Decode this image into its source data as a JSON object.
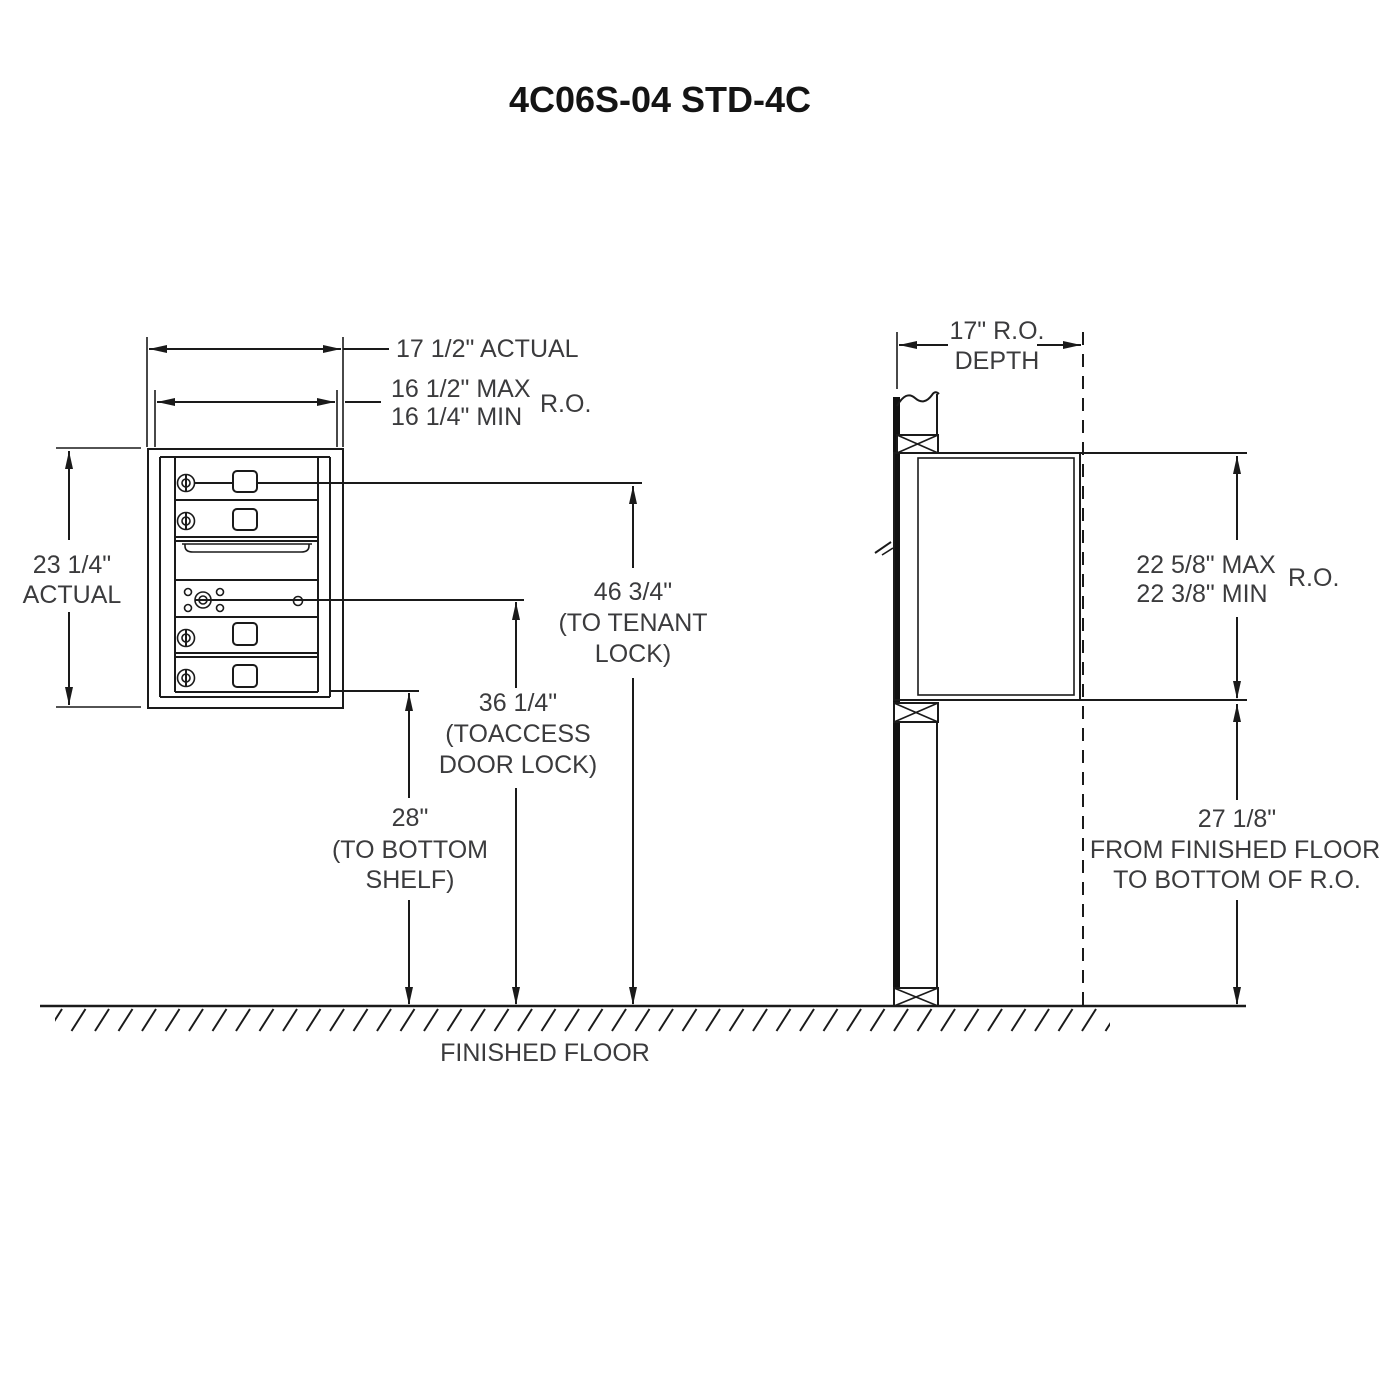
{
  "title": "4C06S-04 STD-4C",
  "front_view": {
    "width_actual_label": "17 1/2\" ACTUAL",
    "width_ro_max": "16 1/2\" MAX",
    "width_ro_min": "16 1/4\" MIN",
    "width_ro_suffix": "R.O.",
    "height_actual_value": "23 1/4\"",
    "height_actual_word": "ACTUAL",
    "tenant_lock_value": "46 3/4\"",
    "tenant_lock_line2": "(TO TENANT",
    "tenant_lock_line3": "LOCK)",
    "access_lock_value": "36 1/4\"",
    "access_lock_line2": "(TOACCESS",
    "access_lock_line3": "DOOR LOCK)",
    "bottom_shelf_value": "28\"",
    "bottom_shelf_line2": "(TO BOTTOM",
    "bottom_shelf_line3": "SHELF)"
  },
  "side_view": {
    "depth_line1": "17\" R.O.",
    "depth_line2": "DEPTH",
    "height_ro_max": "22 5/8\" MAX",
    "height_ro_min": "22 3/8\" MIN",
    "height_ro_suffix": "R.O.",
    "floor_ro_value": "27 1/8\"",
    "floor_ro_line2": "FROM FINISHED FLOOR",
    "floor_ro_line3": "TO BOTTOM OF R.O."
  },
  "floor": {
    "label": "FINISHED FLOOR"
  },
  "colors": {
    "line": "#1a1a1a",
    "text": "#3b3b3d",
    "background": "#ffffff"
  }
}
